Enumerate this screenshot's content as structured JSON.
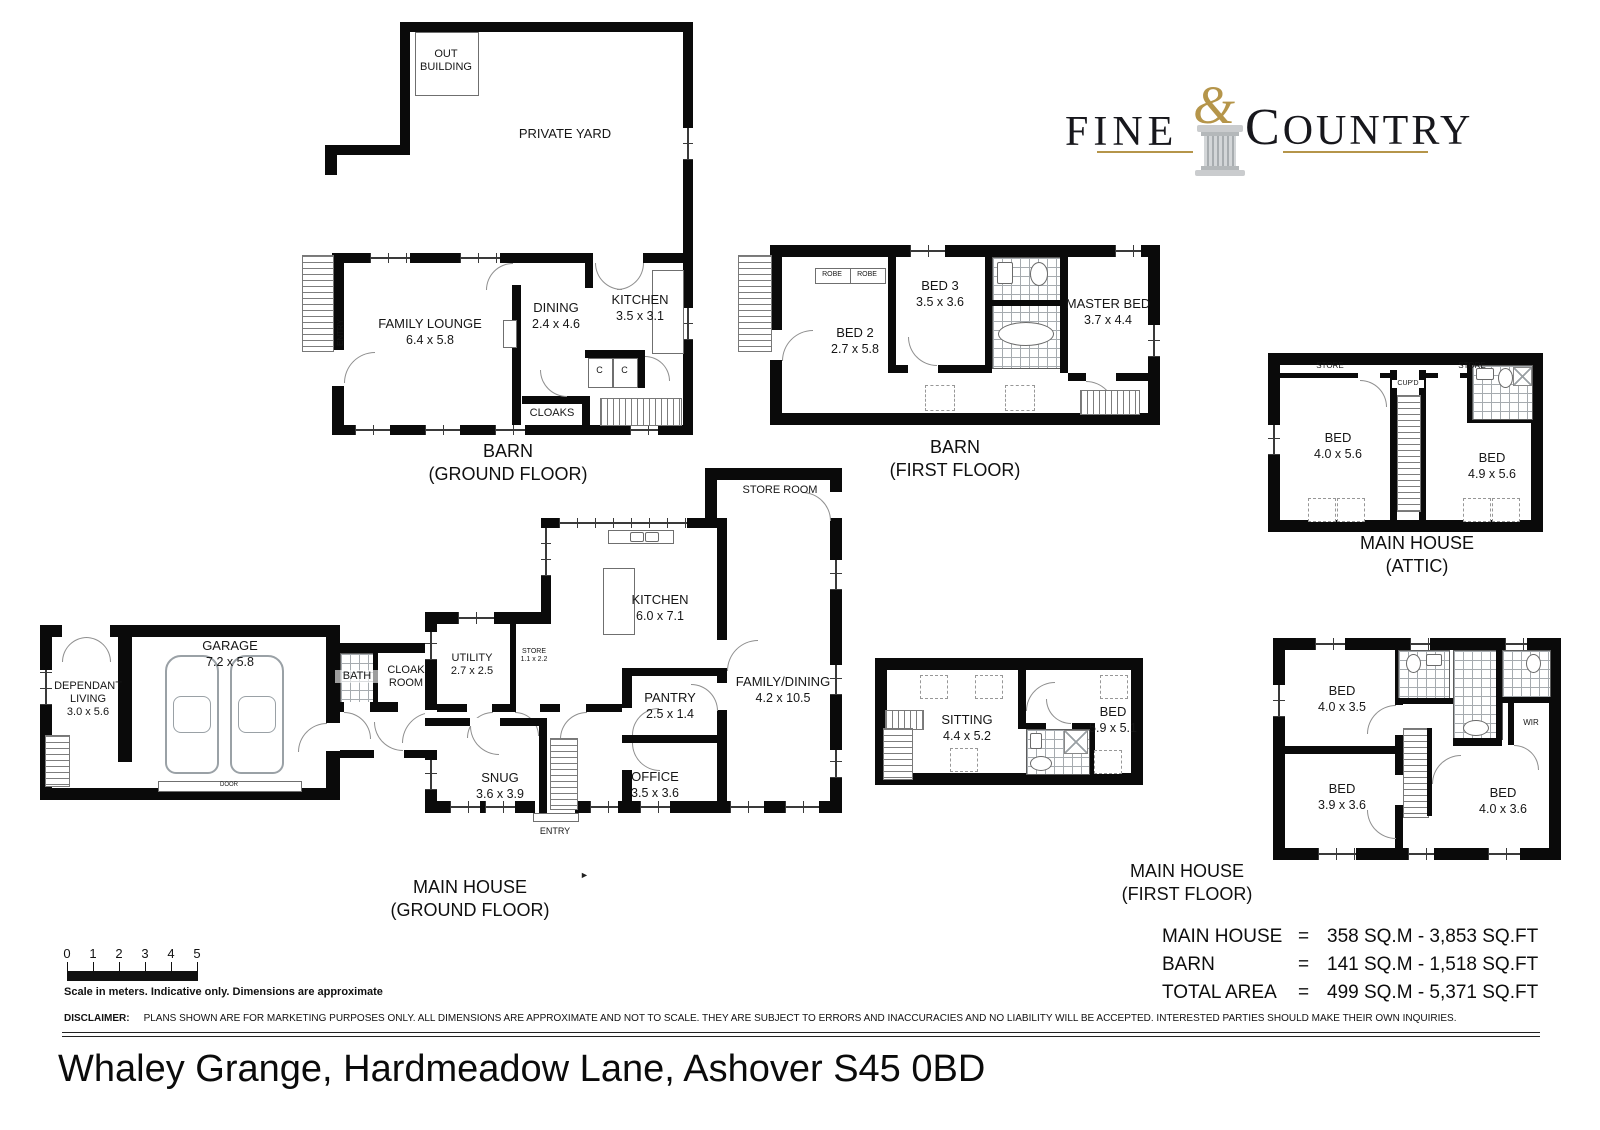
{
  "page": {
    "address": "Whaley Grange, Hardmeadow Lane, Ashover S45 0BD",
    "disclaimer_label": "DISCLAIMER:",
    "disclaimer_text": "PLANS SHOWN ARE FOR MARKETING PURPOSES ONLY. ALL DIMENSIONS ARE APPROXIMATE AND NOT TO SCALE. THEY ARE SUBJECT TO ERRORS AND INACCURACIES AND NO LIABILITY WILL BE ACCEPTED. INTERESTED PARTIES SHOULD MAKE THEIR OWN INQUIRIES.",
    "scale": {
      "ticks": [
        "0",
        "1",
        "2",
        "3",
        "4",
        "5"
      ],
      "caption": "Scale in meters. Indicative only. Dimensions are approximate"
    }
  },
  "logo": {
    "word1": "FINE",
    "ampersand": "&",
    "word2_initial": "C",
    "word2_rest": "OUNTRY",
    "colors": {
      "gold": "#b5954a",
      "column_gray": "#c6c9cb",
      "text": "#17171c"
    }
  },
  "areas": {
    "rows": [
      {
        "label": "MAIN HOUSE",
        "eq": "=",
        "value": "358 SQ.M - 3,853 SQ.FT"
      },
      {
        "label": "BARN",
        "eq": "=",
        "value": "141 SQ.M - 1,518 SQ.FT"
      },
      {
        "label": "TOTAL AREA",
        "eq": "=",
        "value": "499 SQ.M - 5,371 SQ.FT"
      }
    ]
  },
  "titles": {
    "barn_ground": {
      "line1": "BARN",
      "line2": "(GROUND FLOOR)"
    },
    "barn_first": {
      "line1": "BARN",
      "line2": "(FIRST FLOOR)"
    },
    "attic": {
      "line1": "MAIN HOUSE",
      "line2": "(ATTIC)"
    },
    "mh_ground": {
      "line1": "MAIN HOUSE",
      "line2": "(GROUND FLOOR)"
    },
    "mh_first": {
      "line1": "MAIN HOUSE",
      "line2": "(FIRST FLOOR)"
    }
  },
  "rooms": {
    "barn_ground": {
      "out_building": {
        "name": "OUT BUILDING"
      },
      "private_yard": {
        "name": "PRIVATE YARD"
      },
      "family_lounge": {
        "name": "FAMILY LOUNGE",
        "dims": "6.4 x 5.8"
      },
      "dining": {
        "name": "DINING",
        "dims": "2.4 x 4.6"
      },
      "kitchen": {
        "name": "KITCHEN",
        "dims": "3.5 x 3.1"
      },
      "cloaks": {
        "name": "CLOAKS"
      },
      "cupboard1": "C",
      "cupboard2": "C",
      "entry": "ENTRY"
    },
    "barn_first": {
      "bed2": {
        "name": "BED 2",
        "dims": "2.7 x 5.8"
      },
      "bed3": {
        "name": "BED 3",
        "dims": "3.5 x 3.6"
      },
      "master": {
        "name": "MASTER BED",
        "dims": "3.7 x 4.4"
      },
      "robe1": "ROBE",
      "robe2": "ROBE"
    },
    "attic": {
      "store1": "STORE",
      "store2": "STORE",
      "cupd": "CUP'D",
      "bed1": {
        "name": "BED",
        "dims": "4.0 x 5.6"
      },
      "bed2": {
        "name": "BED",
        "dims": "4.9 x 5.6"
      }
    },
    "mh_ground": {
      "dependant": {
        "name": "DEPENDANT LIVING",
        "dims": "3.0 x 5.6"
      },
      "garage": {
        "name": "GARAGE",
        "dims": "7.2 x 5.8"
      },
      "door": "DOOR",
      "bath": {
        "name": "BATH"
      },
      "cloak": {
        "name": "CLOAK ROOM"
      },
      "utility": {
        "name": "UTILITY",
        "dims": "2.7 x 2.5"
      },
      "store_small": {
        "name": "STORE",
        "dims": "1.1 x 2.2"
      },
      "kitchen": {
        "name": "KITCHEN",
        "dims": "6.0 x 7.1"
      },
      "store_room": {
        "name": "STORE ROOM"
      },
      "family_dining": {
        "name": "FAMILY/DINING",
        "dims": "4.2 x 10.5"
      },
      "pantry": {
        "name": "PANTRY",
        "dims": "2.5 x 1.4"
      },
      "office": {
        "name": "OFFICE",
        "dims": "3.5 x 3.6"
      },
      "snug": {
        "name": "SNUG",
        "dims": "3.6 x 3.9"
      },
      "entry": "ENTRY"
    },
    "mh_first_wing": {
      "sitting": {
        "name": "SITTING",
        "dims": "4.4 x 5.2"
      },
      "bed": {
        "name": "BED",
        "dims": "5.9 x 5.1"
      }
    },
    "mh_first": {
      "bed1": {
        "name": "BED",
        "dims": "4.0 x 3.5"
      },
      "bed2": {
        "name": "BED",
        "dims": "3.9 x 3.6"
      },
      "bed3": {
        "name": "BED",
        "dims": "4.0 x 3.6"
      },
      "wir": "WIR"
    }
  }
}
